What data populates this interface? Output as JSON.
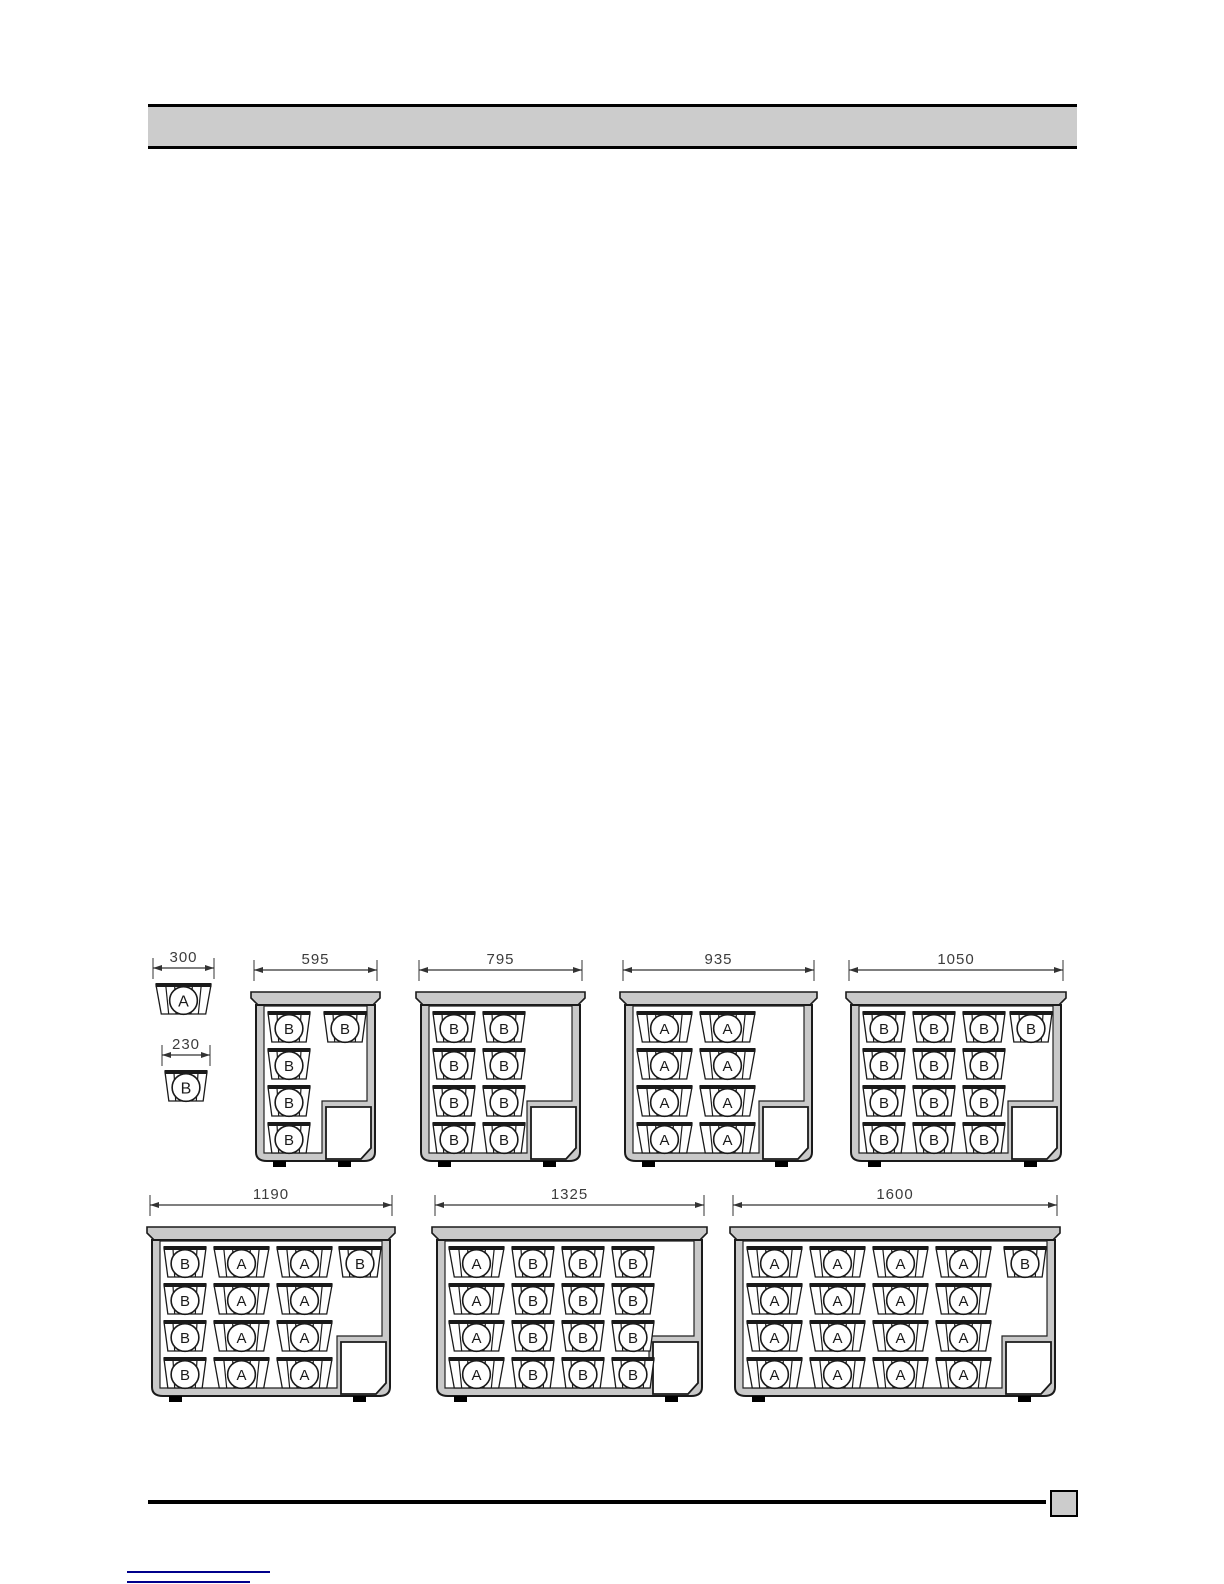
{
  "header": {
    "text": ""
  },
  "legend": {
    "baskets": [
      {
        "letter": "A",
        "dim_label": "300",
        "width_mm": 300
      },
      {
        "letter": "B",
        "dim_label": "230",
        "width_mm": 230
      }
    ]
  },
  "diagram": {
    "type": "technical-diagram",
    "description": "Chest freezer cross-sections showing basket configurations per cabinet width (mm)",
    "basket_types": {
      "A": {
        "width_mm": 300
      },
      "B": {
        "width_mm": 230
      }
    },
    "cabinets": [
      {
        "dim_label": "595",
        "width_mm": 595,
        "columns": [
          "B"
        ],
        "rows_per_column": 4,
        "top_right_basket": "B"
      },
      {
        "dim_label": "795",
        "width_mm": 795,
        "columns": [
          "B",
          "B"
        ],
        "rows_per_column": 4,
        "top_right_basket": null
      },
      {
        "dim_label": "935",
        "width_mm": 935,
        "columns": [
          "A",
          "A"
        ],
        "rows_per_column": 4,
        "top_right_basket": null
      },
      {
        "dim_label": "1050",
        "width_mm": 1050,
        "columns": [
          "B",
          "B",
          "B"
        ],
        "rows_per_column": 4,
        "top_right_basket": "B"
      },
      {
        "dim_label": "1190",
        "width_mm": 1190,
        "columns": [
          "B",
          "A",
          "A"
        ],
        "rows_per_column": 4,
        "top_right_basket": "B"
      },
      {
        "dim_label": "1325",
        "width_mm": 1325,
        "columns": [
          "A",
          "B",
          "B",
          "B"
        ],
        "rows_per_column": 4,
        "top_right_basket": null
      },
      {
        "dim_label": "1600",
        "width_mm": 1600,
        "columns": [
          "A",
          "A",
          "A",
          "A"
        ],
        "rows_per_column": 4,
        "top_right_basket": "B"
      }
    ]
  },
  "footer": {
    "page_box_label": ""
  },
  "colors": {
    "wall_gray": "#c9c9c9",
    "line_black": "#1a1a1a",
    "dim_text": "#3c3c3c",
    "link_navy": "#00008b"
  }
}
